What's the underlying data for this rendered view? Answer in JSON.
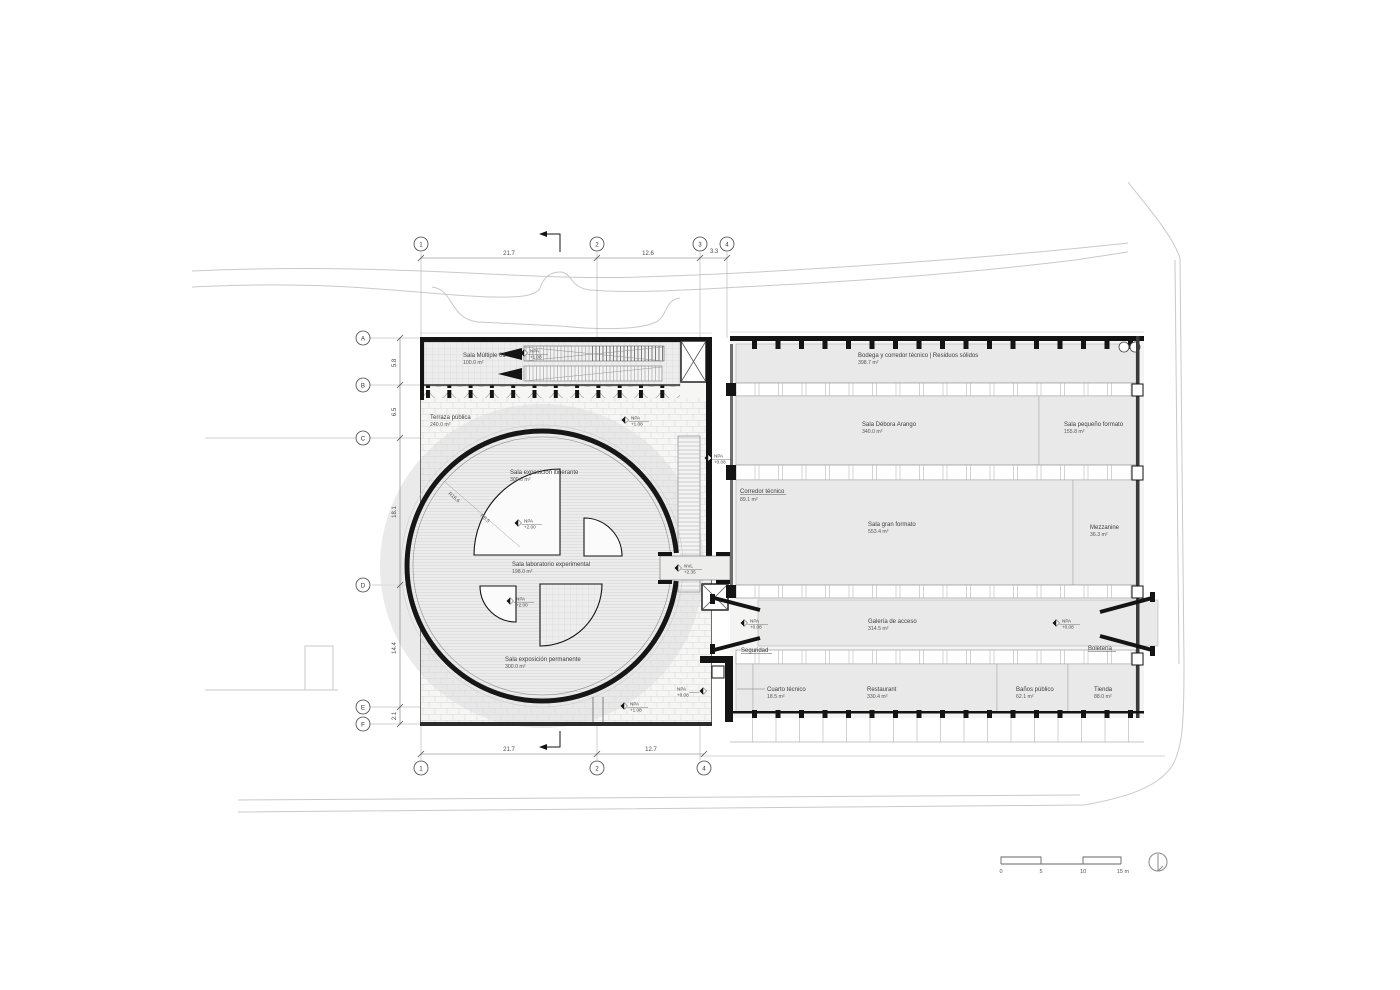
{
  "rooms": {
    "multiple": {
      "name": "Sala Múltiple 01",
      "area": "100.0 m²"
    },
    "terraza": {
      "name": "Terraza pública",
      "area": "240.0 m²"
    },
    "itinerante": {
      "name": "Sala exposición itinerante",
      "area": "300.0 m²"
    },
    "laboratorio": {
      "name": "Sala laboratorio experimental",
      "area": "198.0 m²"
    },
    "permanente": {
      "name": "Sala exposición permanente",
      "area": "300.0 m²"
    },
    "bodega": {
      "name": "Bodega y corredor técnico  |  Residuos sólidos",
      "area": "398.7 m²"
    },
    "debora": {
      "name": "Sala Débora Arango",
      "area": "340.0 m²"
    },
    "pequeno": {
      "name": "Sala pequeño formato",
      "area": "155.8 m²"
    },
    "corredor": {
      "name": "Corredor técnico",
      "area": "89.1 m²"
    },
    "gran": {
      "name": "Sala gran formato",
      "area": "553.4 m²"
    },
    "mezzanine": {
      "name": "Mezzanine",
      "area": "36.3 m²"
    },
    "galeria": {
      "name": "Galería de acceso",
      "area": "314.5 m²"
    },
    "seguridad": {
      "name": "Seguridad"
    },
    "boleteria": {
      "name": "Boletería"
    },
    "cuarto": {
      "name": "Cuarto técnico",
      "area": "18.5 m²"
    },
    "restaurant": {
      "name": "Restaurant",
      "area": "330.4 m²"
    },
    "banos": {
      "name": "Baños público",
      "area": "62.1 m²"
    },
    "tienda": {
      "name": "Tienda",
      "area": "88.0 m²"
    }
  },
  "radii": {
    "outer": "R16.6",
    "inner": "R8.5"
  },
  "grid": {
    "top": [
      "1",
      "2",
      "3",
      "4"
    ],
    "bottom": [
      "1",
      "2",
      "4"
    ],
    "left": [
      "A",
      "B",
      "C",
      "D",
      "E",
      "F"
    ]
  },
  "dims": {
    "top": {
      "d1": "21.7",
      "d2": "12.6",
      "d3": "3.3"
    },
    "bottom": {
      "d1": "21.7",
      "d2": "12.7"
    },
    "left": {
      "d1": "5.8",
      "d2": "6.5",
      "d3": "18.1",
      "d4": "14.4",
      "d5": "2.1"
    }
  },
  "markers": {
    "m1": {
      "ref": "NPA",
      "level": "+1.08"
    },
    "m2": {
      "ref": "NPA",
      "level": "+1.08"
    },
    "m3": {
      "ref": "NPA",
      "level": "+0.08"
    },
    "m4": {
      "ref": "NPA",
      "level": "+2.00"
    },
    "m5": {
      "ref": "NPA",
      "level": "+2.00"
    },
    "m6": {
      "ref": "NVL",
      "level": "+2.35"
    },
    "m7": {
      "ref": "NPA",
      "level": "+0.08"
    },
    "m8": {
      "ref": "NPA",
      "level": "+0.08"
    },
    "m9": {
      "ref": "NPA",
      "level": "+1.08"
    },
    "m10": {
      "ref": "NPA",
      "level": "+0.08"
    }
  },
  "scalebar": {
    "t0": "0",
    "t1": "5",
    "t2": "10",
    "t3": "15 m"
  },
  "colors": {
    "wall": "#161616",
    "room_fill": "#e9e9e9",
    "context": "#c9c9c9",
    "accent": "#3d3d3d"
  }
}
